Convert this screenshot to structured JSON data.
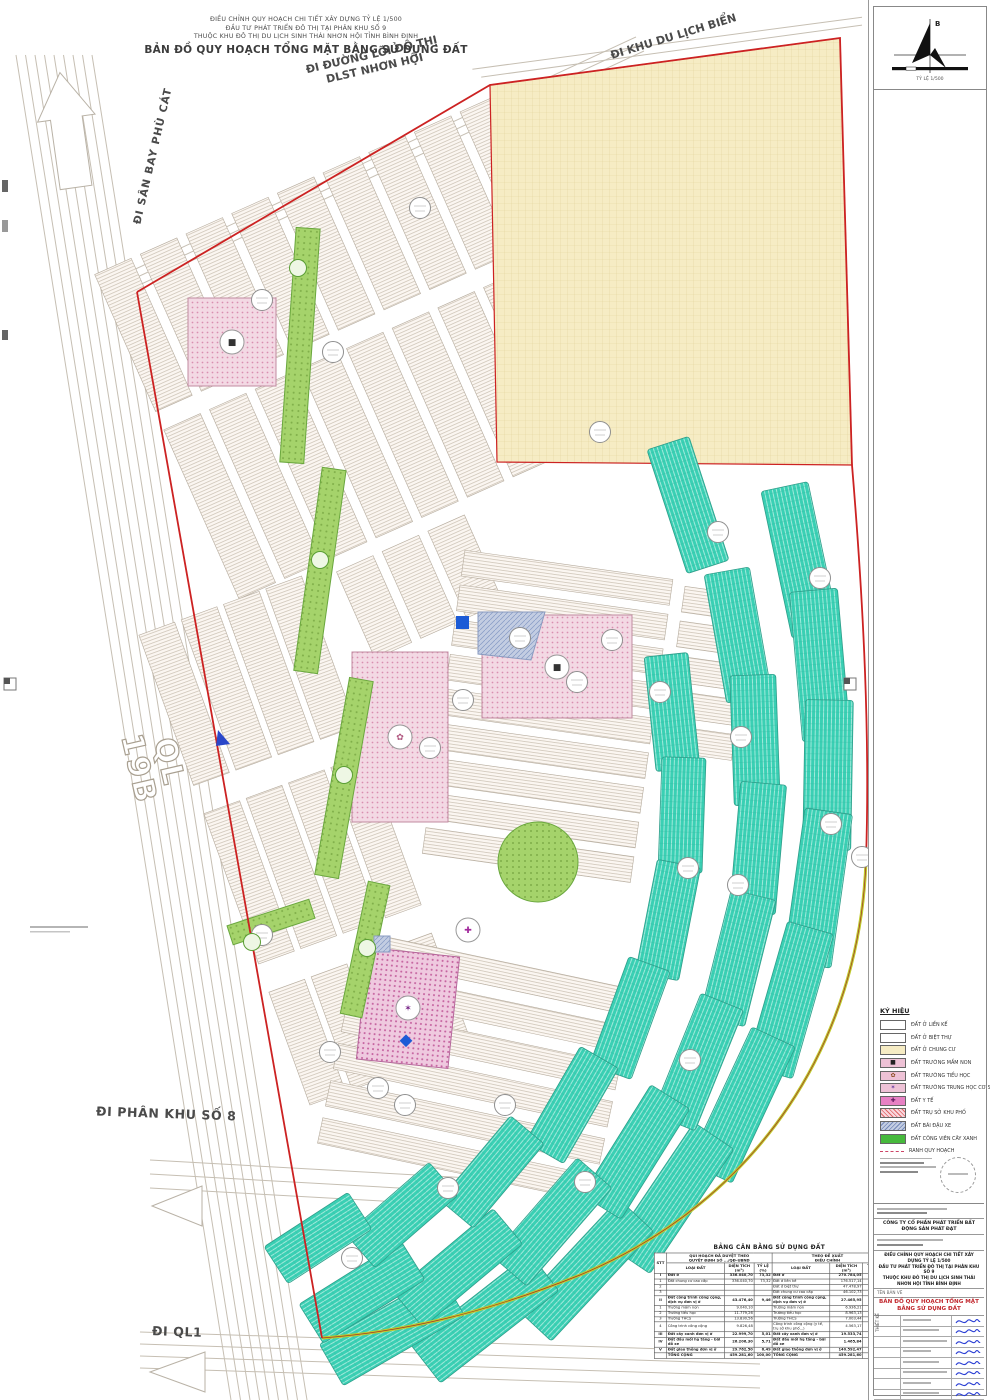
{
  "header": {
    "line1": "ĐIỀU CHỈNH QUY HOẠCH CHI TIẾT XÂY DỰNG TỶ LỆ 1/500",
    "line2": "ĐẦU TƯ PHÁT TRIỂN ĐÔ THỊ TẠI PHÂN KHU SỐ 9",
    "line3": "THUỘC KHU ĐÔ THỊ DU LỊCH SINH THÁI NHƠN HỘI TỈNH BÌNH ĐỊNH",
    "title": "BẢN ĐỒ  QUY HOẠCH TỔNG MẶT BẰNG SỬ DỤNG ĐẤT"
  },
  "roads": {
    "airport": "ĐI SÂN BAY PHÙ CÁT",
    "axis1": "ĐI ĐƯỜNG LÕI ĐÔ THỊ",
    "axis2": "DLST NHƠN HỘI",
    "beach": "ĐI KHU DU LỊCH BIỂN",
    "ql19b_1": "QL",
    "ql19b_2": "19B",
    "subzone8": "ĐI PHÂN KHU SỐ 8",
    "ql1": "ĐI QL1"
  },
  "compass": {
    "north": "B",
    "scale": "TỶ LỆ 1/500"
  },
  "legend": {
    "title": "KÝ HIỆU",
    "items": [
      {
        "label": "ĐẤT Ở LIỀN KẾ",
        "color": "#ffffff",
        "style": "plain"
      },
      {
        "label": "ĐẤT Ở BIỆT THỰ",
        "color": "#ffffff",
        "style": "plain"
      },
      {
        "label": "ĐẤT Ở CHUNG CƯ",
        "color": "#f6ecc4",
        "style": "plain"
      },
      {
        "label": "ĐẤT TRƯỜNG MẦM NON",
        "color": "#eec2d6",
        "style": "glyph",
        "glyph": "■",
        "glyph_color": "#222222"
      },
      {
        "label": "ĐẤT TRƯỜNG TIỂU HỌC",
        "color": "#eec2d6",
        "style": "glyph",
        "glyph": "✿",
        "glyph_color": "#8a4b20"
      },
      {
        "label": "ĐẤT TRƯỜNG TRUNG HỌC CƠ SỞ",
        "color": "#eec2d6",
        "style": "glyph",
        "glyph": "✶",
        "glyph_color": "#6b3fa0"
      },
      {
        "label": "ĐẤT Y TẾ",
        "color": "#e781c4",
        "style": "glyph",
        "glyph": "✚",
        "glyph_color": "#5c155c"
      },
      {
        "label": "ĐẤT TRỤ SỞ KHU PHỐ",
        "color": "#f8d7de",
        "style": "hatch-red"
      },
      {
        "label": "ĐẤT BÃI ĐẬU XE",
        "color": "#c3cde2",
        "style": "hatch-blue"
      },
      {
        "label": "ĐẤT CÔNG VIÊN CÂY XANH",
        "color": "#46b93c",
        "style": "plain"
      },
      {
        "label": "RANH QUY HOẠCH",
        "color": "",
        "style": "dash"
      }
    ]
  },
  "balance_table": {
    "title": "BẢNG CÂN BẰNG SỬ DỤNG ĐẤT",
    "group_left_1": "QUI HOẠCH ĐÃ DUYỆT THEO",
    "group_left_2": "QUYẾT ĐỊNH SỐ .../QĐ-UBND",
    "group_right_1": "THEO ĐỀ XUẤT",
    "group_right_2": "ĐIỀU CHỈNH",
    "col_stt": "STT",
    "col_type": "LOẠI ĐẤT",
    "col_area": "DIỆN TÍCH (m²)",
    "col_ratio": "TỶ LỆ (%)",
    "rows": [
      {
        "stt": "I",
        "lt": "Đất ở",
        "la": "336.040,70",
        "lr": "73,32",
        "rt": "Đất ở",
        "ra": "270.784,05",
        "rr": "58,94",
        "k": "section"
      },
      {
        "stt": "1",
        "lt": "Đất chung cư cao cấp",
        "la": "336.040,70",
        "lr": "73,32",
        "rt": "Đất ở liền kề",
        "ra": "176.517,14",
        "rr": "38,42",
        "k": "sub"
      },
      {
        "stt": "2",
        "lt": "",
        "la": "",
        "lr": "",
        "rt": "Đất ở biệt thự",
        "ra": "47.478,97",
        "rr": "10,34",
        "k": "sub"
      },
      {
        "stt": "3",
        "lt": "",
        "la": "",
        "lr": "",
        "rt": "Đất chung cư cao cấp",
        "ra": "46.102,73",
        "rr": "10,18",
        "k": "sub"
      },
      {
        "stt": "II",
        "lt": "Đất công trình công cộng, dịch vụ đơn vị ở",
        "la": "43.476,40",
        "lr": "9,46",
        "rt": "Đất công trình công cộng, dịch vụ đơn vị ở",
        "ra": "27.465,95",
        "rr": "5,98",
        "k": "section"
      },
      {
        "stt": "1",
        "lt": "Trường mầm non",
        "la": "9.040,10",
        "lr": "",
        "rt": "Trường mầm non",
        "ra": "6.936,21",
        "rr": "",
        "k": "sub"
      },
      {
        "stt": "2",
        "lt": "Trường tiểu học",
        "la": "11.779,26",
        "lr": "",
        "rt": "Trường tiểu học",
        "ra": "8.963,13",
        "rr": "",
        "k": "sub"
      },
      {
        "stt": "3",
        "lt": "Trường THCS",
        "la": "13.830,56",
        "lr": "",
        "rt": "Trường THCS",
        "ra": "7.003,44",
        "rr": "",
        "k": "sub"
      },
      {
        "stt": "4",
        "lt": "Công trình công cộng",
        "la": "9.826,48",
        "lr": "",
        "rt": "Công trình công cộng (y tế, trụ sở khu phố...)",
        "ra": "4.563,17",
        "rr": "",
        "k": "sub"
      },
      {
        "stt": "III",
        "lt": "Đất cây xanh đơn vị ở",
        "la": "22.999,70",
        "lr": "5,01",
        "rt": "Đất cây xanh đơn vị ở",
        "ra": "19.533,74",
        "rr": "4,21",
        "k": "section"
      },
      {
        "stt": "IV",
        "lt": "Đất đầu mối hạ tầng - bãi đỗ xe",
        "la": "26.206,30",
        "lr": "5,71",
        "rt": "Đất đầu mối hạ tầng - bãi đỗ xe",
        "ra": "1.465,84",
        "rr": "0,32",
        "k": "section"
      },
      {
        "stt": "V",
        "lt": "Đất giao thông đơn vị ở",
        "la": "29.762,50",
        "lr": "6,49",
        "rt": "Đất giao thông đơn vị ở",
        "ra": "140.592,47",
        "rr": "30,55",
        "k": "section"
      },
      {
        "stt": "",
        "lt": "TỔNG CỘNG",
        "la": "459.281,60",
        "lr": "100,00",
        "rt": "TỔNG CỘNG",
        "ra": "459.281,60",
        "rr": "100,00",
        "k": "total"
      }
    ]
  },
  "title_block": {
    "investor": "CÔNG TY CỔ PHẦN PHÁT TRIỂN BẤT ĐỘNG SẢN PHÁT ĐẠT",
    "project1": "ĐIỀU CHỈNH QUY HOẠCH CHI TIẾT XÂY DỰNG TỶ LỆ 1/500",
    "project2": "ĐẦU TƯ PHÁT TRIỂN ĐÔ THỊ TẠI PHÂN KHU SỐ 9",
    "project3": "THUỘC KHU ĐÔ THỊ DU LỊCH SINH THÁI NHƠN HỘI TỈNH BÌNH ĐỊNH",
    "drawing_label": "TÊN BẢN VẼ",
    "drawing_title": "BẢN ĐỒ QUY HOẠCH TỔNG MẶT BẰNG SỬ DỤNG ĐẤT",
    "design_label": "THIẾT KẾ",
    "firm": "HUY HOÀNG"
  },
  "colors": {
    "teal": "#3ad0b4",
    "apartment_yellow": "#f6ecc4",
    "school_pink": "#f3d9e4",
    "park_green": "#a5d36b",
    "parking_blue": "#c3cde2",
    "boundary_red": "#cc2222",
    "boundary_yellowgreen": "#bfca2c"
  }
}
